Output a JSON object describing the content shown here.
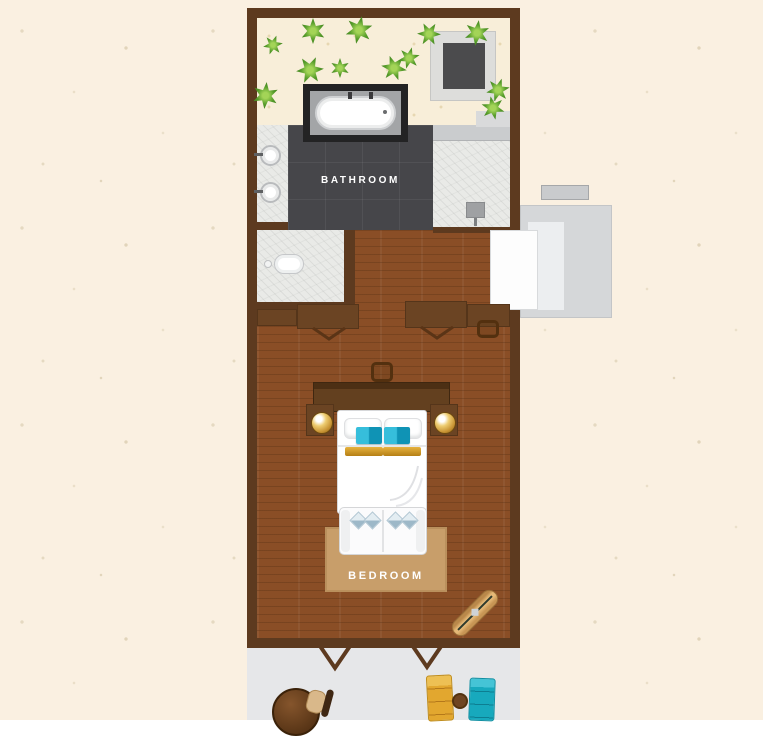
{
  "plan": {
    "type": "villa-floor-plan",
    "rooms": {
      "bathroom": {
        "label": "BATHROOM"
      },
      "bedroom": {
        "label": "BEDROOM"
      }
    },
    "colors": {
      "background": "#faf0e1",
      "wall": "#5d3a1f",
      "wood_floor": "#8a4e26",
      "bathroom_tile": "#46464a",
      "marble": "#e9eae7",
      "sand": "#f8eed9",
      "deck": "#e6e7e9",
      "entry_deck": "#d5d7d9",
      "rug": "#c89e6a",
      "accent_teal": "#17a9c0",
      "accent_gold": "#dfa32b",
      "plant_green": "#569c2b"
    },
    "icons": {
      "plant-icon": "star-burst-foliage",
      "bathtub-icon": "oval-tub",
      "sink-icon": "round-basin",
      "toilet-icon": "oval-bowl",
      "bed-icon": "double-bed-top-view",
      "lamp-icon": "round-gold-lamp",
      "sun-lounger-icon": "lounger-top-view",
      "door-swing-icon": "v-swing"
    }
  }
}
